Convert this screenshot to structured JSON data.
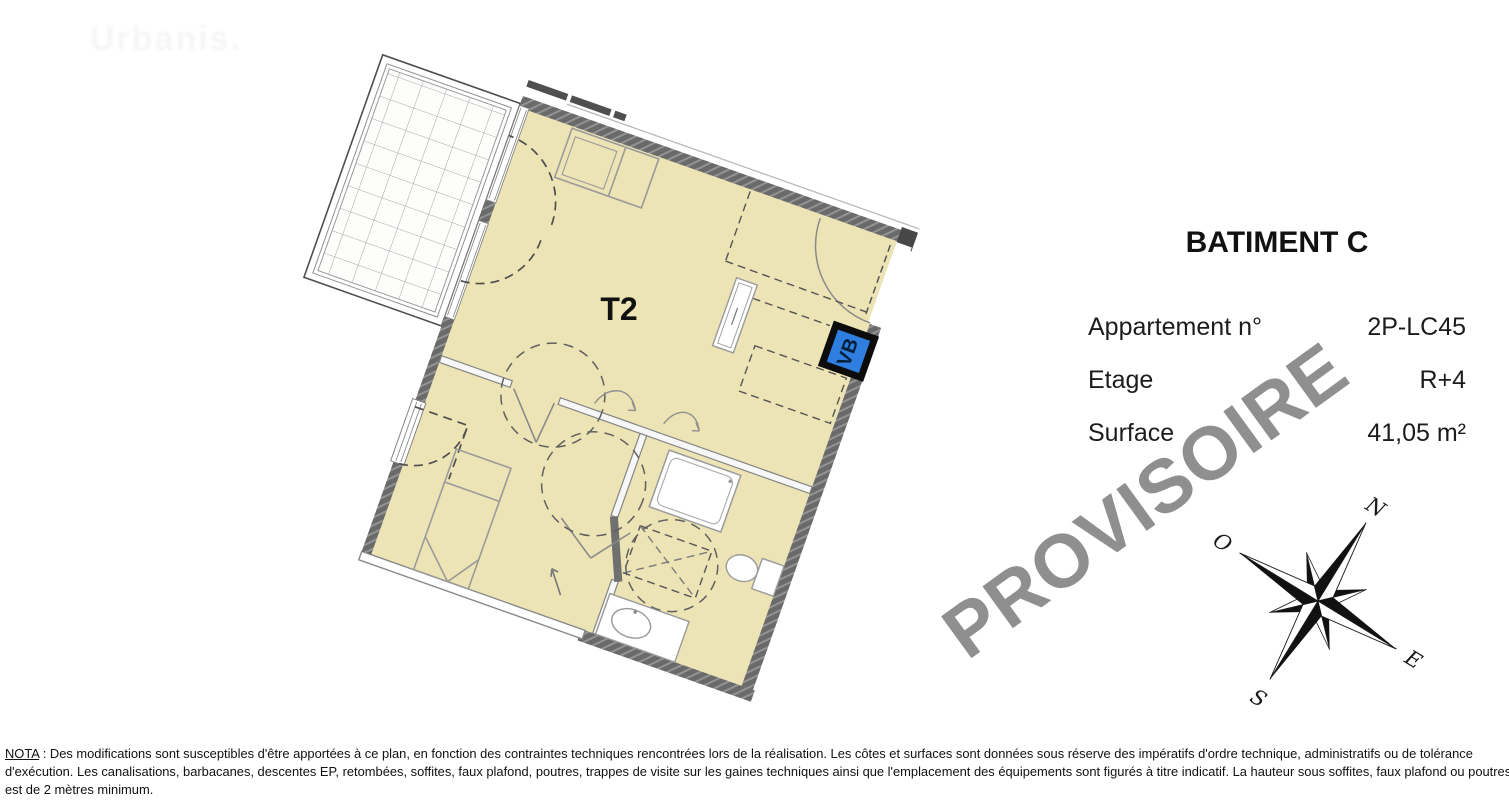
{
  "faded_logo": "Urbanis.",
  "plan": {
    "unit_label": "T2",
    "vb_label": "VB",
    "colors": {
      "floor_beige": "#EDE4B5",
      "wall_gray": "#6A6A6A",
      "vb_blue": "#2E7FE0",
      "watermark_gray": "#878787"
    }
  },
  "info_panel": {
    "building": "BATIMENT C",
    "rows": [
      {
        "label": "Appartement n°",
        "value": "2P-LC45"
      },
      {
        "label": "Etage",
        "value": "R+4"
      },
      {
        "label": "Surface",
        "value": "41,05 m²"
      }
    ]
  },
  "compass": {
    "north": "N",
    "east": "E",
    "south": "S",
    "west": "O"
  },
  "watermark": {
    "text": "PROVISOIRE"
  },
  "nota": {
    "label": "NOTA",
    "line1_rest": " : Des modifications sont susceptibles d'être apportées à ce plan, en fonction des contraintes techniques rencontrées lors de la réalisation. Les côtes et surfaces sont données sous réserve des impératifs d'ordre technique, administratifs ou de tolérance",
    "line2": "d'exécution. Les canalisations, barbacanes, descentes EP, retombées, soffites, faux plafond, poutres, trappes de visite sur les gaines techniques ainsi que l'emplacement des équipements sont figurés à titre indicatif. La hauteur sous soffites, faux plafond ou poutres",
    "line3": "est de 2 mètres minimum."
  }
}
